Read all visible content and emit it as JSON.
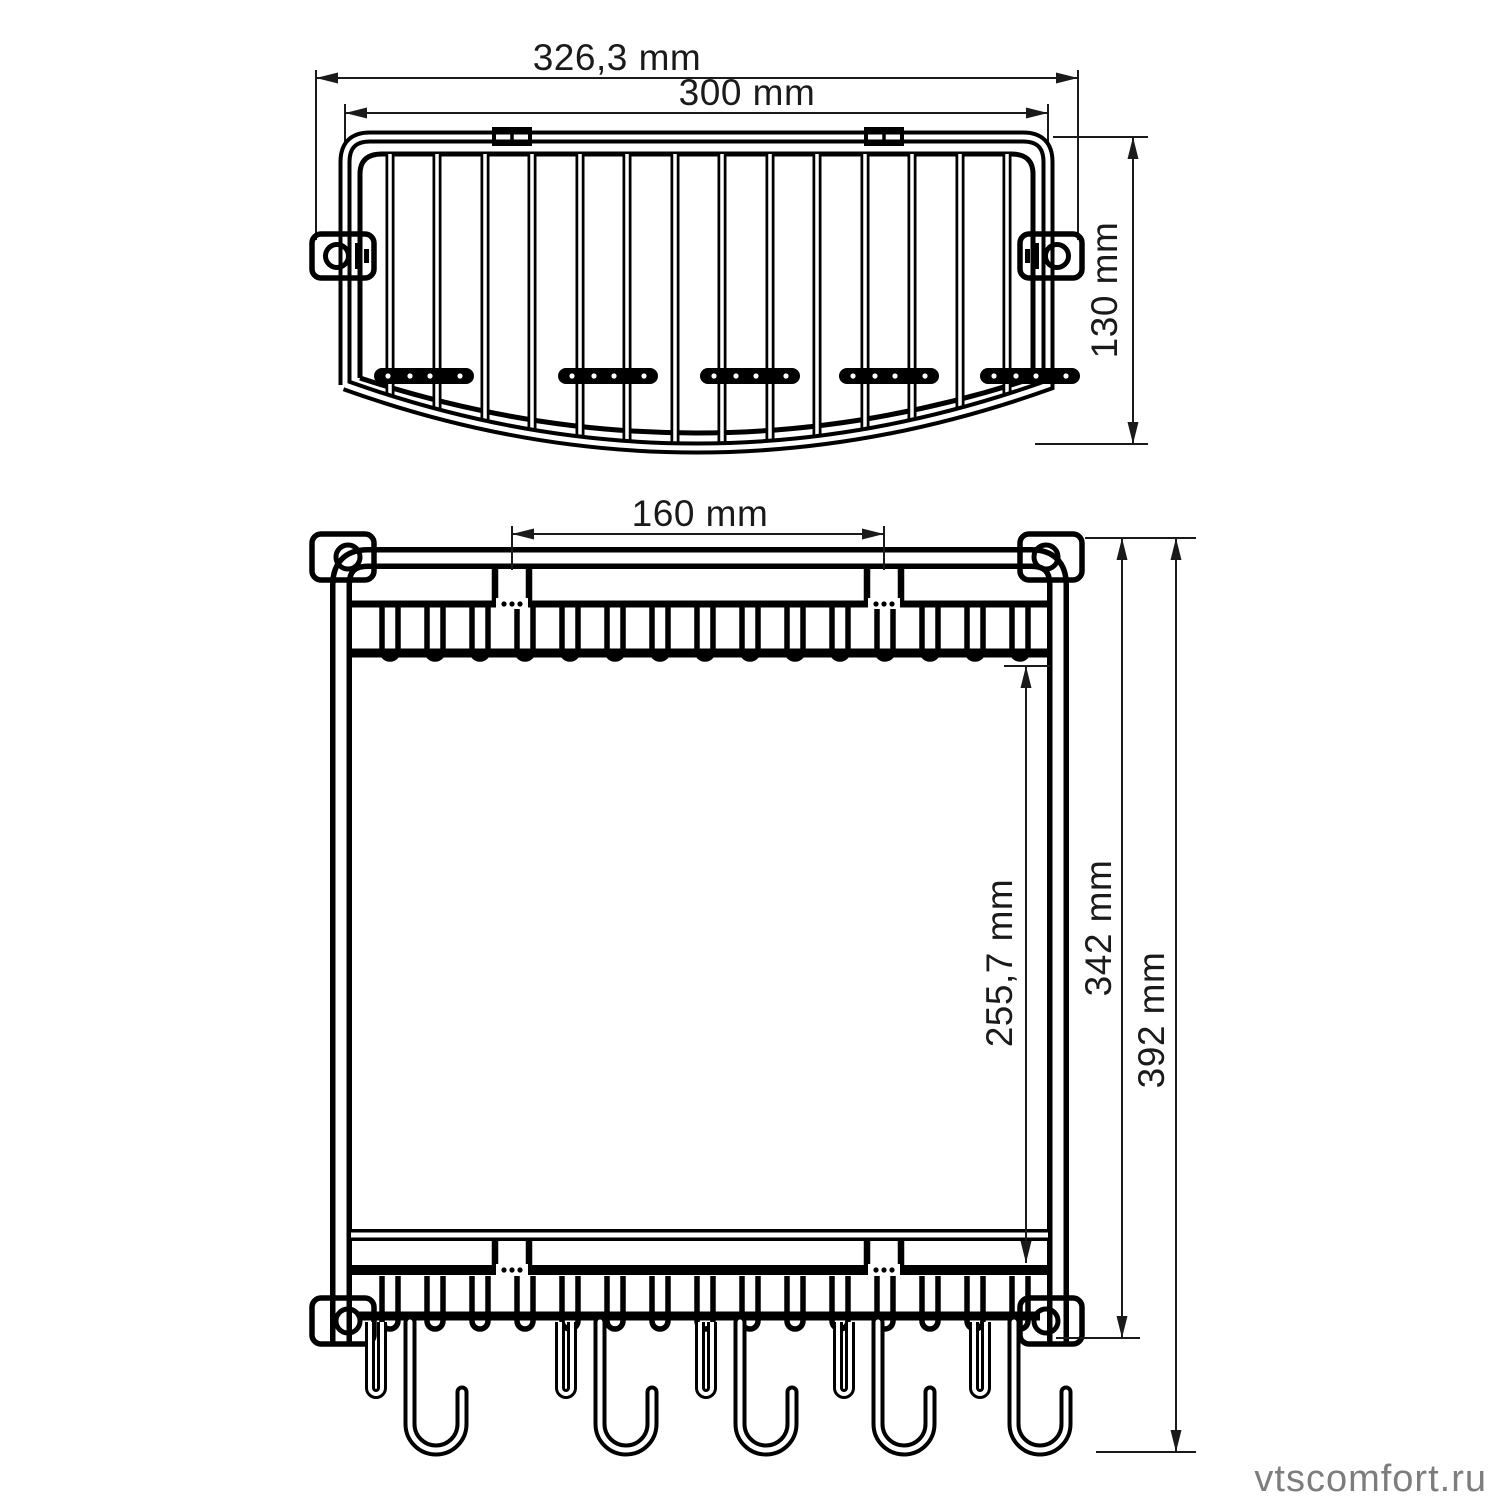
{
  "drawing": {
    "background": "#ffffff",
    "line_color": "#000000",
    "dim_text_color": "#1a1a1a",
    "top_view": {
      "dim_outer_width": "326,3 mm",
      "dim_inner_width": "300 mm",
      "dim_depth": "130 mm"
    },
    "front_view": {
      "dim_clip_spacing": "160 mm",
      "dim_shelf_gap": "255,7 mm",
      "dim_frame_height": "342 mm",
      "dim_overall_height": "392 mm"
    },
    "watermark": {
      "text": "vtscomfort.ru",
      "color": "#7d7d7d"
    }
  }
}
